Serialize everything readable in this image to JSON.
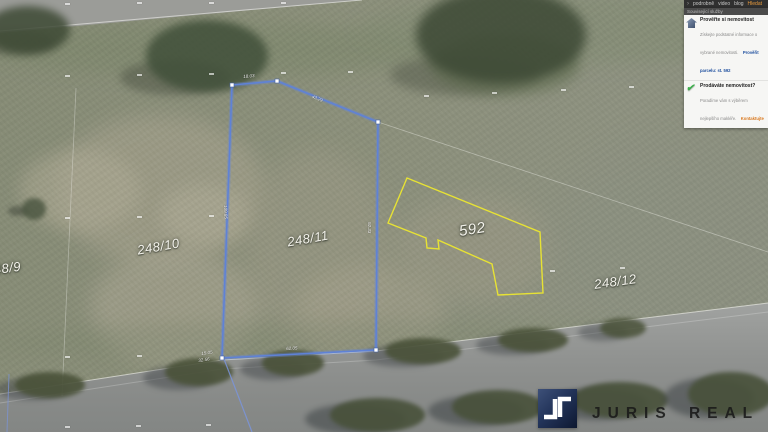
{
  "topbar": {
    "arrow": "›",
    "items": [
      "podrobně",
      "video",
      "blog"
    ],
    "active_item": "Hledat"
  },
  "services_panel": {
    "header": "Související služby",
    "items": [
      {
        "icon": "house-icon",
        "title": "Prověřte si nemovitost",
        "description": "Získejte podstatné informace o vybrané nemovitosti.",
        "link": "Prověřit parcelu: st. 592"
      },
      {
        "icon": "check-icon",
        "title": "Prodáváte nemovitost?",
        "description": "Poradíme vám s výběrem nejlepšího makléře.",
        "link": "Kontaktujte"
      }
    ]
  },
  "map": {
    "parcel_labels": [
      {
        "text": "248/9"
      },
      {
        "text": "248/10"
      },
      {
        "text": "248/11"
      },
      {
        "text": "592"
      },
      {
        "text": "248/12"
      }
    ],
    "selected_parcel": {
      "number": "248/11",
      "outline_color": "#5f82d6",
      "dimension_labels": [
        "18.03",
        "43.29",
        "92.33",
        "62.05",
        "15.05",
        "32.56",
        "109.85"
      ]
    },
    "building_parcel": {
      "number": "592",
      "outline_color": "#e7e234"
    }
  },
  "watermark": {
    "brand": "JURIS REAL"
  }
}
